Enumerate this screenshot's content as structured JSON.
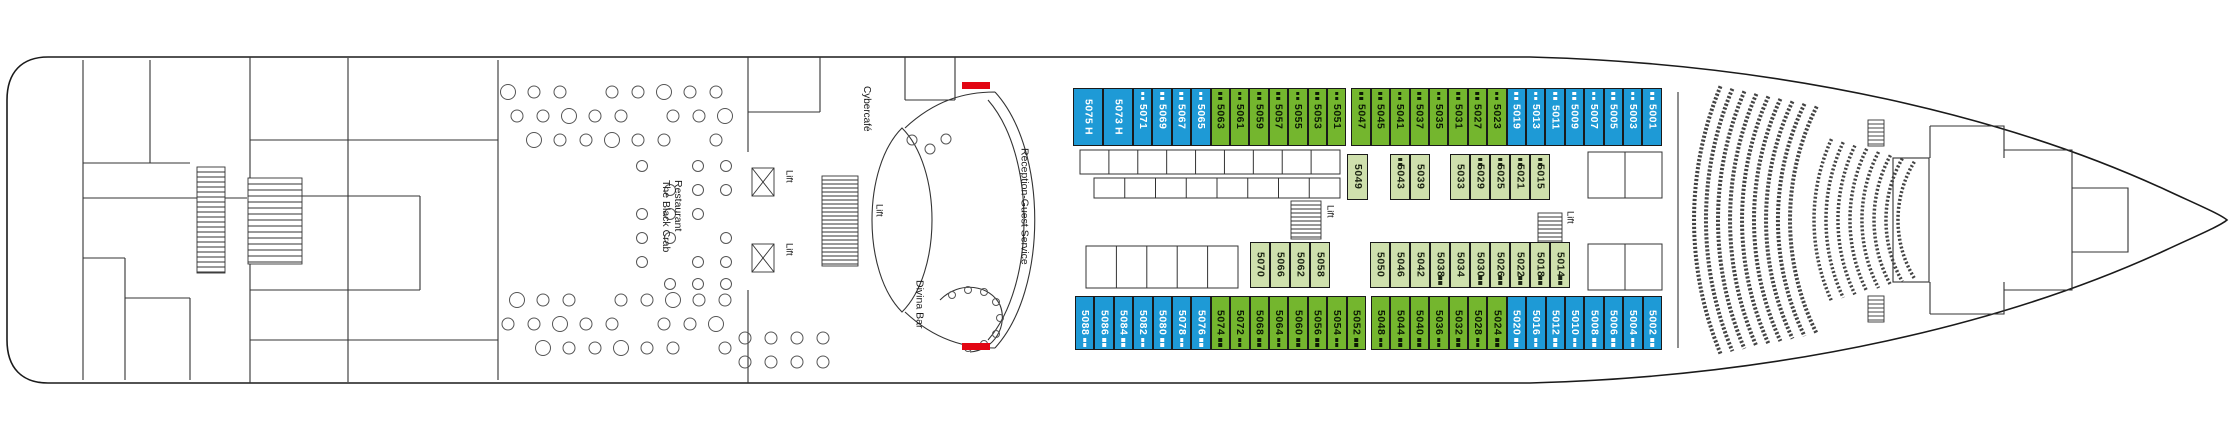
{
  "deck_plan": {
    "labels": {
      "cybercafe": "Cybercafé",
      "restaurant_line1": "The Black Crab",
      "restaurant_line2": "Restaurant",
      "reception": "Reception-Guest Service",
      "divina_bar": "Divina Bar",
      "lift": "Lift"
    },
    "colors": {
      "balcony_blue": "#1e9ad6",
      "outside_green": "#74b62e",
      "inside_green": "#cfe0ad",
      "fire_door_red": "#e20613"
    },
    "cabin_rows": {
      "top": [
        {
          "num": "5075",
          "tag": "H",
          "type": "balcony",
          "w": 30
        },
        {
          "num": "5073",
          "tag": "H",
          "type": "balcony",
          "w": 30
        },
        {
          "num": "5071",
          "type": "balcony",
          "marker": true
        },
        {
          "num": "5069",
          "type": "balcony",
          "marker": true
        },
        {
          "num": "5067",
          "type": "balcony",
          "marker": true
        },
        {
          "num": "5065",
          "type": "balcony",
          "marker": true
        },
        {
          "num": "5063",
          "type": "outside",
          "marker": true
        },
        {
          "num": "5061",
          "type": "outside",
          "marker": true
        },
        {
          "num": "5059",
          "type": "outside",
          "marker": true
        },
        {
          "num": "5057",
          "type": "outside",
          "marker": true
        },
        {
          "num": "5055",
          "type": "outside",
          "marker": true
        },
        {
          "num": "5053",
          "type": "outside",
          "marker": true
        },
        {
          "num": "5051",
          "type": "outside",
          "marker": true
        },
        {
          "gap": 5
        },
        {
          "num": "5047",
          "type": "outside",
          "marker": true
        },
        {
          "num": "5045",
          "type": "outside",
          "marker": true
        },
        {
          "num": "5041",
          "type": "outside",
          "marker": true
        },
        {
          "num": "5037",
          "type": "outside",
          "marker": true
        },
        {
          "num": "5035",
          "type": "outside",
          "marker": true
        },
        {
          "num": "5031",
          "type": "outside",
          "marker": true
        },
        {
          "num": "5027",
          "type": "outside",
          "marker": true
        },
        {
          "num": "5023",
          "type": "outside",
          "marker": true
        },
        {
          "num": "5019",
          "type": "balcony",
          "marker": true
        },
        {
          "num": "5013",
          "type": "balcony",
          "marker": true
        },
        {
          "num": "5011",
          "type": "balcony",
          "marker": true
        },
        {
          "num": "5009",
          "type": "balcony",
          "marker": true
        },
        {
          "num": "5007",
          "type": "balcony",
          "marker": true
        },
        {
          "num": "5005",
          "type": "balcony",
          "marker": true
        },
        {
          "num": "5003",
          "type": "balcony",
          "marker": true
        },
        {
          "num": "5001",
          "type": "balcony",
          "marker": true
        }
      ],
      "mid_upper": [
        {
          "num": "5049",
          "type": "inside",
          "w": 21
        },
        {
          "gap": 22
        },
        {
          "num": "5043",
          "type": "inside",
          "w": 20,
          "marker": true
        },
        {
          "num": "5039",
          "type": "inside",
          "w": 20
        },
        {
          "gap": 20
        },
        {
          "num": "5033",
          "type": "inside",
          "w": 20
        },
        {
          "num": "5029",
          "type": "inside",
          "w": 20,
          "marker": true
        },
        {
          "num": "5025",
          "type": "inside",
          "w": 20,
          "marker": true
        },
        {
          "num": "5021",
          "type": "inside",
          "w": 20,
          "marker": true
        },
        {
          "num": "5015",
          "type": "inside",
          "w": 20,
          "marker": true
        }
      ],
      "mid_lower": [
        {
          "num": "5070",
          "type": "inside",
          "w": 20
        },
        {
          "num": "5066",
          "type": "inside",
          "w": 20
        },
        {
          "num": "5062",
          "type": "inside",
          "w": 20
        },
        {
          "num": "5058",
          "type": "inside",
          "w": 20
        },
        {
          "gap": 40
        },
        {
          "num": "5050",
          "type": "inside",
          "w": 20
        },
        {
          "num": "5046",
          "type": "inside",
          "w": 20
        },
        {
          "num": "5042",
          "type": "inside",
          "w": 20
        },
        {
          "num": "5038",
          "type": "inside",
          "w": 20,
          "marker": true
        },
        {
          "num": "5034",
          "type": "inside",
          "w": 20
        },
        {
          "num": "5030",
          "type": "inside",
          "w": 20,
          "marker": true
        },
        {
          "num": "5026",
          "type": "inside",
          "w": 20,
          "marker": true
        },
        {
          "num": "5022",
          "type": "inside",
          "w": 20,
          "marker": true
        },
        {
          "num": "5018",
          "type": "inside",
          "w": 20,
          "marker": true
        },
        {
          "num": "5014",
          "type": "inside",
          "w": 20,
          "marker": true
        }
      ],
      "bottom": [
        {
          "num": "5088",
          "type": "balcony",
          "marker": true
        },
        {
          "num": "5086",
          "type": "balcony",
          "marker": true
        },
        {
          "num": "5084",
          "type": "balcony",
          "marker": true
        },
        {
          "num": "5082",
          "type": "balcony",
          "marker": true
        },
        {
          "num": "5080",
          "type": "balcony",
          "marker": true
        },
        {
          "num": "5078",
          "type": "balcony",
          "marker": true
        },
        {
          "num": "5076",
          "type": "balcony",
          "marker": true
        },
        {
          "num": "5074",
          "type": "outside",
          "marker": true
        },
        {
          "num": "5072",
          "type": "outside",
          "marker": true
        },
        {
          "num": "5068",
          "type": "outside",
          "marker": true
        },
        {
          "num": "5064",
          "type": "outside",
          "marker": true
        },
        {
          "num": "5060",
          "type": "outside",
          "marker": true
        },
        {
          "num": "5056",
          "type": "outside",
          "marker": true
        },
        {
          "num": "5054",
          "type": "outside",
          "marker": true
        },
        {
          "num": "5052",
          "type": "outside",
          "marker": true
        },
        {
          "gap": 5
        },
        {
          "num": "5048",
          "type": "outside",
          "marker": true
        },
        {
          "num": "5044",
          "type": "outside",
          "marker": true
        },
        {
          "num": "5040",
          "type": "outside",
          "marker": true
        },
        {
          "num": "5036",
          "type": "outside",
          "marker": true
        },
        {
          "num": "5032",
          "type": "outside",
          "marker": true
        },
        {
          "num": "5028",
          "type": "outside",
          "marker": true
        },
        {
          "num": "5024",
          "type": "outside",
          "marker": true
        },
        {
          "num": "5020",
          "type": "balcony",
          "marker": true
        },
        {
          "num": "5016",
          "type": "balcony",
          "marker": true
        },
        {
          "num": "5012",
          "type": "balcony",
          "marker": true
        },
        {
          "num": "5010",
          "type": "balcony",
          "marker": true
        },
        {
          "num": "5008",
          "type": "balcony",
          "marker": true
        },
        {
          "num": "5006",
          "type": "balcony",
          "marker": true
        },
        {
          "num": "5004",
          "type": "balcony",
          "marker": true
        },
        {
          "num": "5002",
          "type": "balcony",
          "marker": true
        }
      ]
    }
  }
}
